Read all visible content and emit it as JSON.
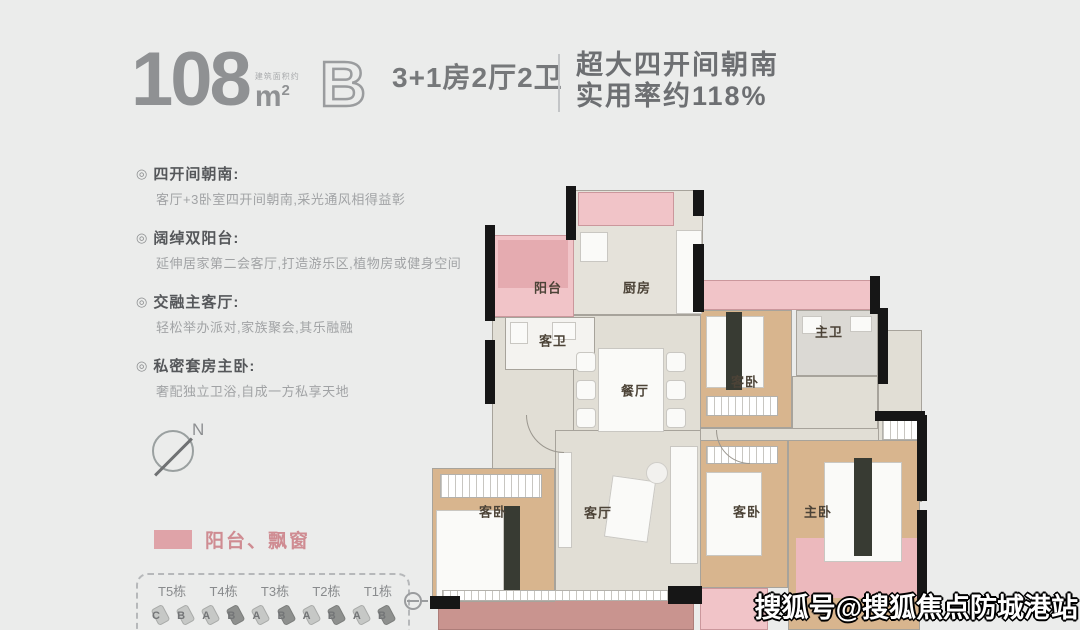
{
  "header": {
    "area_value": "108",
    "area_unit_base": "m",
    "area_unit_sup": "2",
    "area_prefix": "建筑面积约",
    "plan_letter": "B",
    "spec": "3+1房2厅2卫",
    "slogan_line1": "超大四开间朝南",
    "slogan_line2": "实用率约118%"
  },
  "ui": {
    "bullet": "◎"
  },
  "features": [
    {
      "title": "四开间朝南:",
      "desc": "客厅+3卧室四开间朝南,采光通风相得益彰"
    },
    {
      "title": "阔绰双阳台:",
      "desc": "延伸居家第二会客厅,打造游乐区,植物房或健身空间"
    },
    {
      "title": "交融主客厅:",
      "desc": "轻松举办派对,家族聚会,其乐融融"
    },
    {
      "title": "私密套房主卧:",
      "desc": "奢配独立卫浴,自成一方私享天地"
    }
  ],
  "compass": {
    "north_label": "N"
  },
  "legend": {
    "label": "阳台、飘窗",
    "swatch_color": "#dfa3a8"
  },
  "site_strip": {
    "tower_labels": [
      "T5栋",
      "T4栋",
      "T3栋",
      "T2栋",
      "T1栋"
    ],
    "unit_letters": [
      "C",
      "B",
      "A",
      "B",
      "A",
      "B",
      "A",
      "B",
      "A",
      "B"
    ]
  },
  "floorplan": {
    "rooms": {
      "balcony": "阳台",
      "kitchen": "厨房",
      "guest_bath": "客卫",
      "dining": "餐厅",
      "bedroom_top_right": "客卧",
      "master_bath": "主卫",
      "bedroom_bottom_left": "客卧",
      "living": "客厅",
      "bedroom_mid_right": "客卧",
      "master_bedroom": "主卧"
    }
  },
  "watermark": "搜狐号@搜狐焦点防城港站",
  "colors": {
    "accent_pink": "#f1c4c8",
    "bedroom_floor": "#d8b58e",
    "wall_black": "#161616",
    "background": "#ebeceb"
  }
}
